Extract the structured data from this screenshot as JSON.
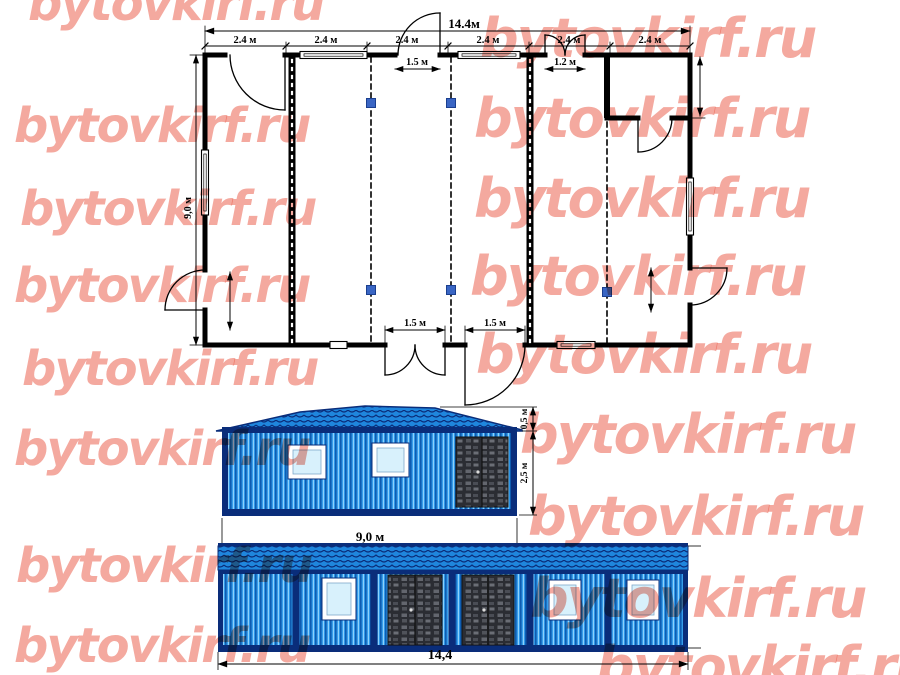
{
  "watermark": {
    "text": "bytovkirf.ru",
    "color": "#ea5440"
  },
  "colors": {
    "wall_blue": "#2f98e8",
    "corrugation_dark": "#0f5cb0",
    "corrugation_light": "#8ed1fb",
    "trim_navy": "#0a2d7a",
    "roof_blue": "#1f86dd",
    "door_dark": "#2b2d33",
    "glass": "#d8f1fc",
    "marker_blue": "#3a66c4",
    "line_black": "#000000"
  },
  "plan": {
    "overall_width": "14.4м",
    "segments": [
      "2.4 м",
      "2.4 м",
      "2.4 м",
      "2.4 м",
      "2.4 м",
      "2.4 м"
    ],
    "top_door_width": "1.5 м",
    "top_double_door_width": "1.2 м",
    "bottom_door_left_width": "1.5 м",
    "bottom_door_right_width": "1.5 м",
    "depth": "9,0 м"
  },
  "side_elevation": {
    "width": "9,0 м",
    "roof_rise": "0,5 м",
    "wall_height": "2,5 м"
  },
  "front_elevation": {
    "width": "14,4"
  }
}
